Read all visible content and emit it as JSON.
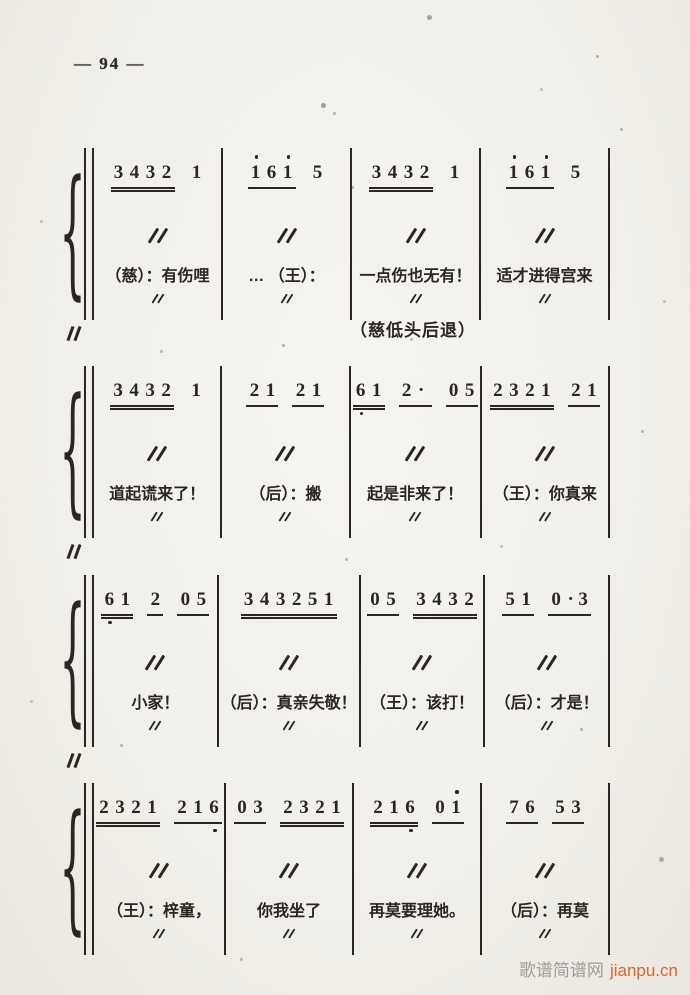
{
  "page": {
    "number_label": "— 94 —",
    "ink_color": "#2a2622",
    "paper_color": "#f1efe9",
    "watermark": {
      "site_name": "歌谱简谱网",
      "site_url": "jianpu.cn"
    }
  },
  "notation": {
    "repeat_mark_symbol": "〃",
    "systems": [
      {
        "left_mark": true,
        "stage_direction": "（慈低头后退）",
        "measures": [
          {
            "groups": [
              {
                "d": "3432",
                "u": 2
              },
              {
                "d": "1",
                "u": 0
              }
            ],
            "ditto": true,
            "lyric": "（慈）：有伤哩",
            "lyric_ditto": true
          },
          {
            "groups": [
              {
                "d": "161",
                "u": 1,
                "hi": [
                  0,
                  2
                ]
              },
              {
                "d": "5",
                "u": 0
              }
            ],
            "ditto": true,
            "lyric": "… （王）：",
            "lyric_ditto": true
          },
          {
            "groups": [
              {
                "d": "3432",
                "u": 2
              },
              {
                "d": "1",
                "u": 0
              }
            ],
            "ditto": true,
            "lyric": "一点伤也无有！",
            "lyric_ditto": true
          },
          {
            "groups": [
              {
                "d": "161",
                "u": 1,
                "hi": [
                  0,
                  2
                ]
              },
              {
                "d": "5",
                "u": 0
              }
            ],
            "ditto": true,
            "lyric": "适才进得宫来",
            "lyric_ditto": true
          }
        ]
      },
      {
        "left_mark": true,
        "stage_direction": "",
        "measures": [
          {
            "groups": [
              {
                "d": "3432",
                "u": 2
              },
              {
                "d": "1",
                "u": 0
              }
            ],
            "ditto": true,
            "lyric": "道起谎来了！",
            "lyric_ditto": true
          },
          {
            "groups": [
              {
                "d": "21",
                "u": 1
              },
              {
                "d": "21",
                "u": 1
              }
            ],
            "ditto": true,
            "lyric": "（后）：搬",
            "lyric_ditto": true
          },
          {
            "groups": [
              {
                "d": "61",
                "u": 2,
                "lo": [
                  0
                ]
              },
              {
                "d": "2.",
                "u": 1
              },
              {
                "d": "05",
                "u": 1
              }
            ],
            "ditto": true,
            "lyric": "起是非来了！",
            "lyric_ditto": true
          },
          {
            "groups": [
              {
                "d": "2321",
                "u": 2
              },
              {
                "d": "21",
                "u": 1
              }
            ],
            "ditto": true,
            "lyric": "（王）：你真来",
            "lyric_ditto": true
          }
        ]
      },
      {
        "left_mark": true,
        "stage_direction": "",
        "measures": [
          {
            "groups": [
              {
                "d": "61",
                "u": 2,
                "lo": [
                  0
                ]
              },
              {
                "d": "2",
                "u": 1
              },
              {
                "d": "05",
                "u": 1
              }
            ],
            "ditto": true,
            "lyric": "小家！",
            "lyric_ditto": true
          },
          {
            "groups": [
              {
                "d": "343251",
                "u": 2
              }
            ],
            "ditto": true,
            "lyric": "（后）：真亲失敬！",
            "lyric_ditto": true
          },
          {
            "groups": [
              {
                "d": "05",
                "u": 1
              },
              {
                "d": "3432",
                "u": 2
              }
            ],
            "ditto": true,
            "lyric": "（王）：该打！",
            "lyric_ditto": true
          },
          {
            "groups": [
              {
                "d": "51",
                "u": 1
              },
              {
                "d": "0.3",
                "u": 1
              }
            ],
            "ditto": true,
            "lyric": "（后）：才是！",
            "lyric_ditto": true
          }
        ]
      },
      {
        "left_mark": false,
        "stage_direction": "",
        "measures": [
          {
            "groups": [
              {
                "d": "2321",
                "u": 2
              },
              {
                "d": "216",
                "u": 1,
                "lo": [
                  2
                ]
              }
            ],
            "ditto": true,
            "lyric": "（王）：梓童，",
            "lyric_ditto": true
          },
          {
            "groups": [
              {
                "d": "03",
                "u": 1
              },
              {
                "d": "2321",
                "u": 2
              }
            ],
            "ditto": true,
            "lyric": "你我坐了",
            "lyric_ditto": true
          },
          {
            "groups": [
              {
                "d": "216",
                "u": 2,
                "lo": [
                  2
                ]
              },
              {
                "d": "01",
                "u": 1,
                "hi": [
                  1
                ]
              }
            ],
            "ditto": true,
            "lyric": "再莫要理她。",
            "lyric_ditto": true
          },
          {
            "groups": [
              {
                "d": "76",
                "u": 1
              },
              {
                "d": "53",
                "u": 1
              }
            ],
            "ditto": true,
            "lyric": "（后）：再莫",
            "lyric_ditto": true
          }
        ]
      }
    ]
  }
}
